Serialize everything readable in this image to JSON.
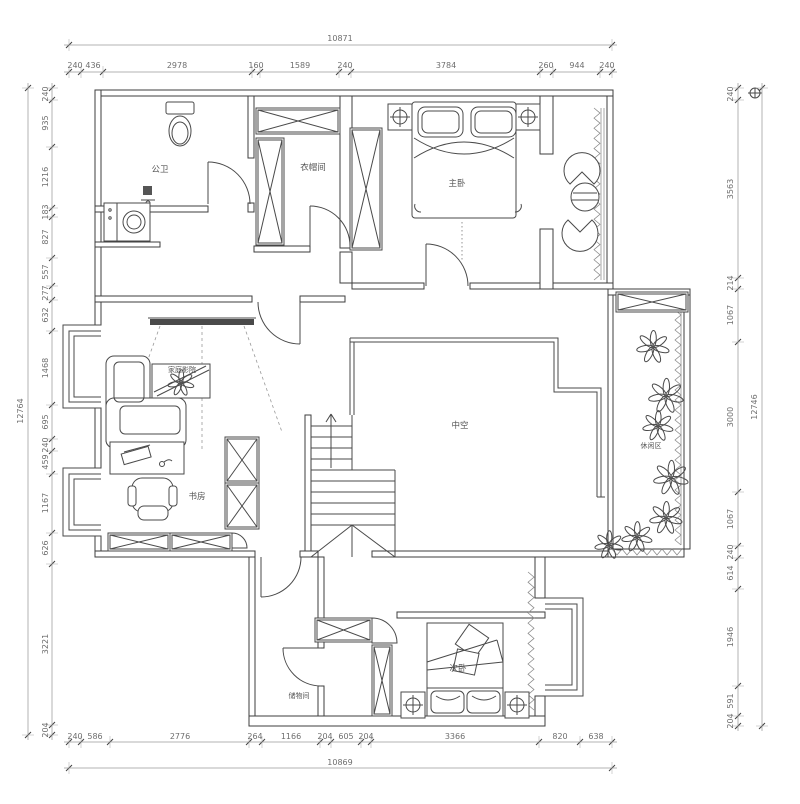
{
  "drawing": {
    "type": "residential-floor-plan-second-level",
    "rooms": {
      "bathroom": "公卫",
      "cloakroom": "衣帽间",
      "master_bedroom": "主卧",
      "home_theater": "家庭影院",
      "study": "书房",
      "void": "中空",
      "leisure": "休闲区",
      "storage": "储物间",
      "second_bedroom": "次卧"
    },
    "dimensions": {
      "top": {
        "overall": "10871",
        "segments": [
          "240",
          "436",
          "2978",
          "160",
          "1589",
          "240",
          "3784",
          "260",
          "944",
          "240"
        ]
      },
      "bottom": {
        "overall": "10869",
        "segments": [
          "240",
          "586",
          "2776",
          "264",
          "1166",
          "204",
          "605",
          "204",
          "3366",
          "820",
          "638"
        ]
      },
      "left": {
        "overall": "12764",
        "segments": [
          "240",
          "935",
          "1216",
          "183",
          "827",
          "557",
          "277",
          "632",
          "1468",
          "695",
          "240",
          "459",
          "1167",
          "626",
          "3221",
          "204"
        ]
      },
      "right": {
        "overall": "12746",
        "segments": [
          "240",
          "3563",
          "214",
          "1067",
          "3000",
          "1067",
          "240",
          "614",
          "1946",
          "591",
          "204"
        ]
      }
    },
    "colors": {
      "wall_line": "#3d3d3d",
      "furniture_line": "#4a4a4a",
      "dimension_text": "#6e6e6e",
      "screen_fill": "#4a4a4a"
    },
    "icons": [
      "toilet-icon",
      "washer-icon",
      "projection-screen-icon",
      "sofa-icon",
      "coffee-table-plant-icon",
      "desk-icon",
      "office-chair-icon",
      "wardrobe-icon",
      "double-bed-icon",
      "nightstand-lamp-icon",
      "armchair-icon",
      "round-table-icon",
      "stairs-up-icon",
      "plant-icon",
      "bay-window-icon",
      "door-swing-icon",
      "marker-icon"
    ]
  }
}
